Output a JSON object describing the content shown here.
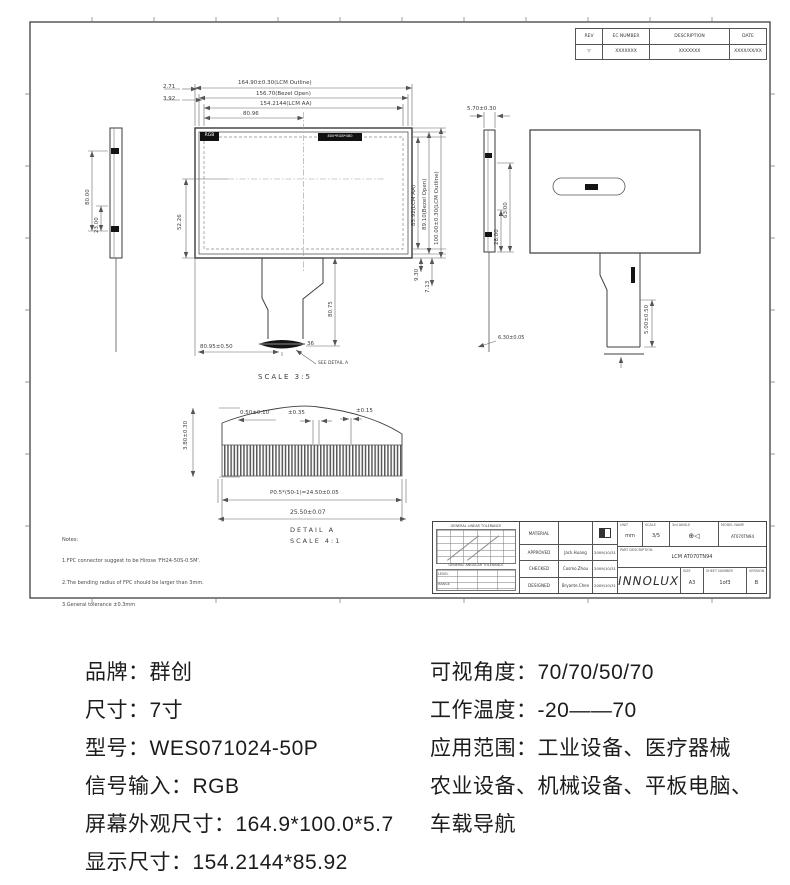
{
  "drawing": {
    "revision_table": {
      "headers": [
        "REV",
        "EC NUMBER",
        "DESCRIPTION",
        "DATE"
      ],
      "row": {
        "rev": "▽",
        "ec_number": "XXXXXXX",
        "description": "XXXXXXX",
        "date": "XXXX/XX/XX"
      }
    },
    "front_view": {
      "screen_label": "RGB",
      "resolution_label": "800*RGB*480",
      "dim_outline_h": "164.90±0.30(LCM Outline)",
      "dim_bezel_h": "156.70(Bezel Open)",
      "dim_aa_h": "154.2144(LCM AA)",
      "dim_center_h": "80.96",
      "dim_offset_bezel": "2.71",
      "dim_offset_aa": "3.92",
      "dim_left_v": "52.26",
      "dim_aa_v": "85.92(LCM AA)",
      "dim_bezel_v": "89.10(Bezel Open)",
      "dim_outline_v": "100.00±0.30(LCM Outline)",
      "dim_9_30": "9.30",
      "dim_7_13": "7.13",
      "dim_tail_len": "80.75",
      "dim_tail_pos": "80.95±0.50",
      "dim_pin": "36",
      "see_detail": "SEE DETAIL A",
      "scale": "SCALE 3:5"
    },
    "left_side_view": {
      "dim_height": "80.00",
      "dim_lower": "23.00"
    },
    "right_side_view": {
      "dim_thickness": "5.70±0.30",
      "dim_63": "63.00",
      "dim_28": "28.00",
      "dim_bottom": "6.30±0.05"
    },
    "rear_view": {
      "dim_tail": "5.00±0.50"
    },
    "detail_a": {
      "dim_height": "3.80±0.30",
      "dim_end": "0.50±0.10",
      "dim_0_35": "±0.35",
      "dim_0_15": "±0.15",
      "dim_pitch": "P0.5*(50-1)=24.50±0.05",
      "dim_total": "25.50±0.07",
      "title": "DETAIL A",
      "scale": "SCALE 4:1"
    },
    "notes": {
      "l0": "Notes:",
      "l1": "1.FPC connector suggest to be Hirose 'FH24-50S-0.5M'.",
      "l2": "2.The bending radius of FPC should be larger than 3mm.",
      "l3": "3.General tolerance ±0.3mm"
    },
    "title_block": {
      "tolerance_header": "GENERAL LINEAR TOLERANCE",
      "angular_header": "GENERAL ANGULAR TOLERANCE",
      "level_label": "LEVEL",
      "range_label": "RANGE",
      "material_label": "MATERIAL",
      "approved_label": "APPROVED",
      "approved_name": "Jack.Huang",
      "approved_date": "2009/10/31",
      "checked_label": "CHECKED",
      "checked_name": "Cosmo.Zhou",
      "checked_date": "2009/10/31",
      "designed_label": "DESIGNED",
      "designed_name": "Bryante.Chen",
      "designed_date": "2009/10/31",
      "unit_label": "UNIT",
      "unit_value": "mm",
      "scale_label": "SCALE",
      "scale_value": "3/5",
      "angle_label": "3rd ANGLE",
      "angle_symbol": "⊕◁",
      "model_label": "MODEL NAME",
      "model_value": "AT070TN94",
      "part_label": "PART DESCRIPTION",
      "part_value": "LCM AT070TN94",
      "logo": "INNOLUX",
      "size_label": "SIZE",
      "size_value": "A3",
      "sheet_label": "SHEET NUMBER",
      "sheet_value": "1of3",
      "version_label": "VERSION",
      "version_value": "B"
    }
  },
  "specs": {
    "left": [
      "品牌：群创",
      "尺寸：7寸",
      "型号：WES071024-50P",
      "信号输入：RGB",
      "屏幕外观尺寸：164.9*100.0*5.7",
      "显示尺寸：154.2144*85.92"
    ],
    "right": [
      "可视角度：70/70/50/70",
      "工作温度：-20——70",
      "应用范围：工业设备、医疗器械",
      "农业设备、机械设备、平板电脑、",
      "车载导航"
    ]
  }
}
